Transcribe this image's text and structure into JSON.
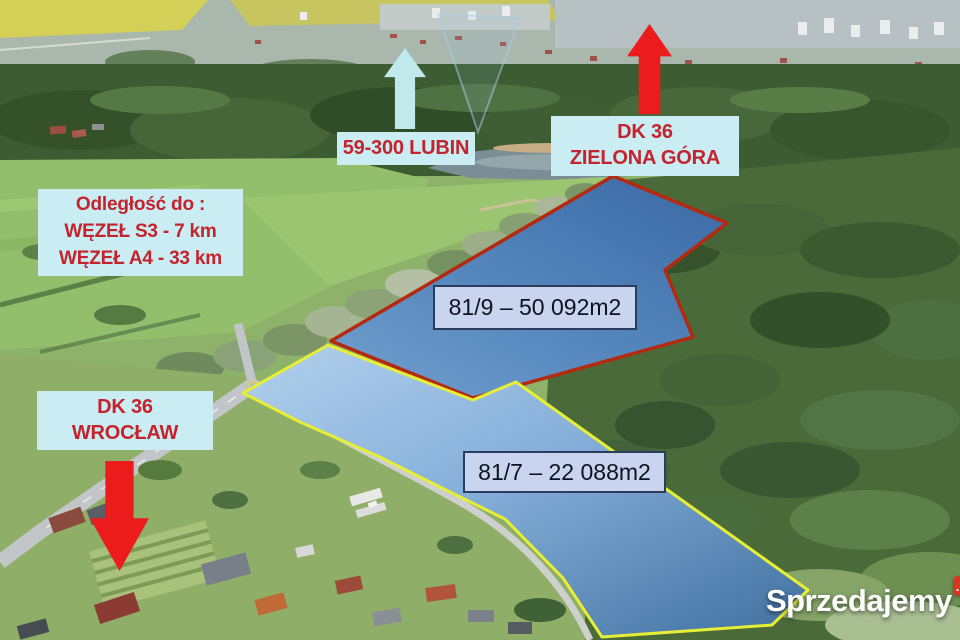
{
  "watermark": {
    "text": "Sprzedajemy",
    "badge": ".pl"
  },
  "annotations": {
    "lubin": {
      "label": "59-300 LUBIN",
      "arrow_direction": "up",
      "arrow_color": "#bfe9ec"
    },
    "zielona_gora": {
      "line1": "DK 36",
      "line2": "ZIELONA GÓRA",
      "arrow_direction": "up",
      "arrow_color": "#ec1c1c"
    },
    "wroclaw": {
      "line1": "DK 36",
      "line2": "WROCŁAW",
      "arrow_direction": "down",
      "arrow_color": "#ec1c1c"
    },
    "distances": {
      "title": "Odległość do :",
      "items": [
        "WĘZEŁ S3 - 7 km",
        "WĘZEŁ A4 - 33 km"
      ]
    }
  },
  "plots": [
    {
      "parcel": "81/9",
      "label": "81/9 – 50 092m2",
      "outline_color": "#b52a0e"
    },
    {
      "parcel": "81/7",
      "label": "81/7 – 22 088m2",
      "outline_color": "#e6ee35"
    }
  ],
  "colors": {
    "info_box_bg": "#c9edf2",
    "info_text": "#c4232e",
    "plot_label_bg": "#c9d5ee",
    "plot_label_border": "#2c3c5e",
    "plot9_fill": "#4c7fb5",
    "plot7_fill": "#7fa9d4",
    "watermark_badge_bg": "#d23923"
  }
}
